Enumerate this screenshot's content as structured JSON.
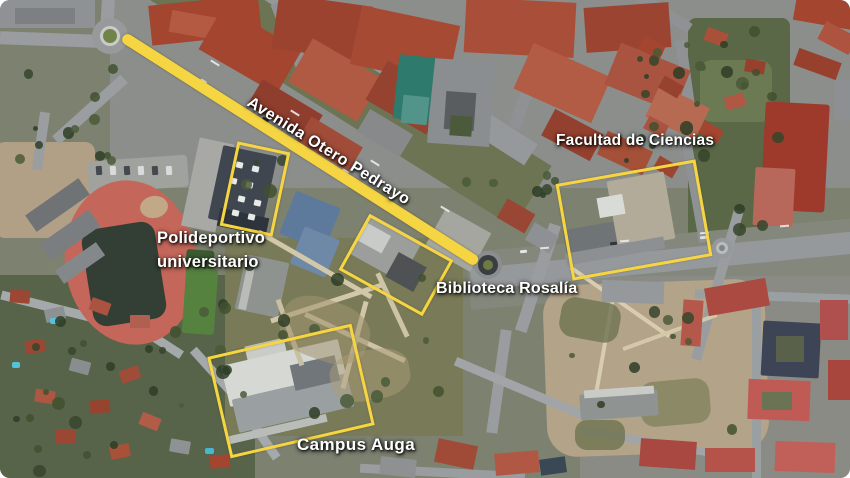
{
  "map": {
    "view": "satellite-aerial",
    "annotation_color": "#F5D542",
    "annotations": [
      {
        "id": "avenue",
        "label": "Avenida Otero Pedrayo",
        "highlight": "line"
      },
      {
        "id": "facultad",
        "label": "Facultad de Ciencias",
        "highlight": "rectangle"
      },
      {
        "id": "polideportivo",
        "label": "Polideportivo universitario",
        "highlight": "rectangle"
      },
      {
        "id": "biblioteca",
        "label": "Biblioteca Rosalía",
        "highlight": "rectangle"
      },
      {
        "id": "campus",
        "label": "Campus Auga",
        "highlight": "rectangle"
      }
    ]
  }
}
